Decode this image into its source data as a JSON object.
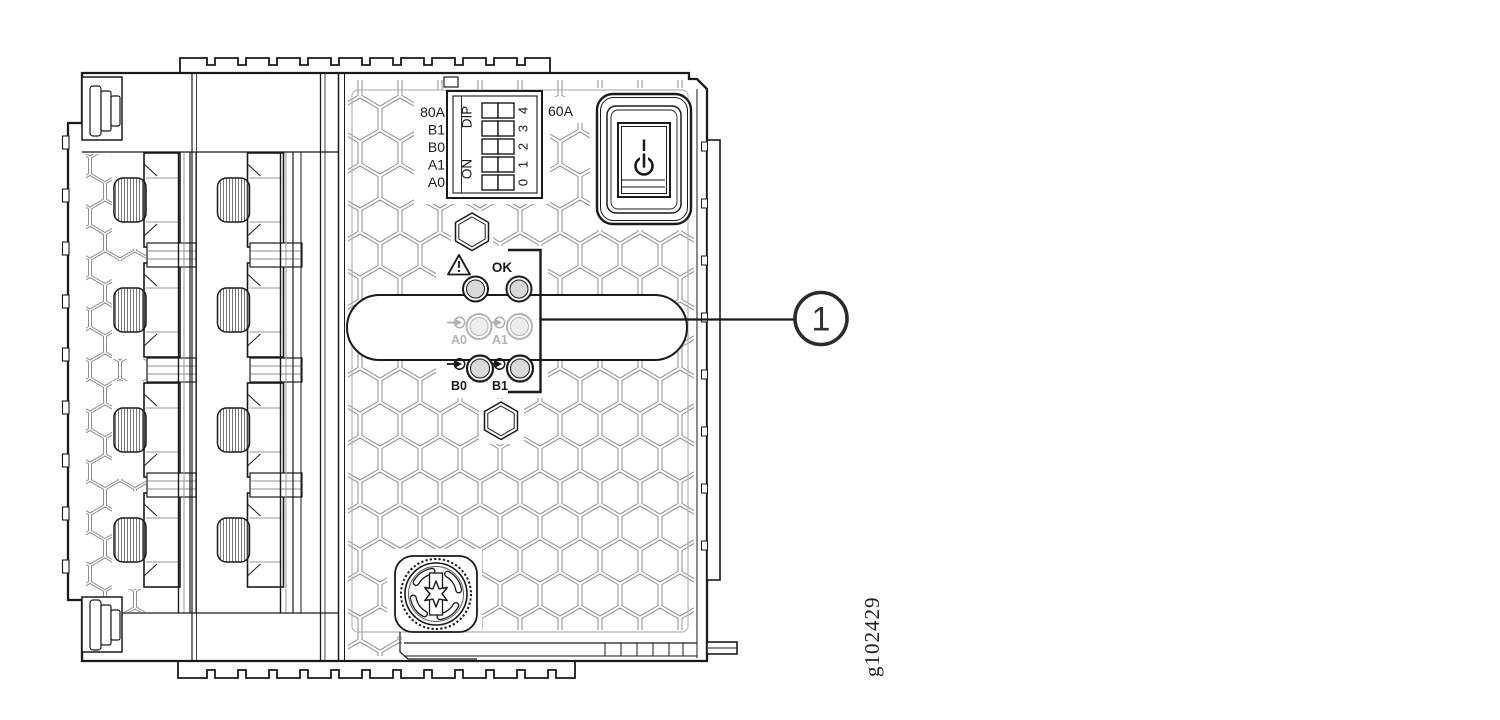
{
  "figure": {
    "id": "g102429"
  },
  "callout": {
    "number": "1",
    "target": "status-led-cluster"
  },
  "panel": {
    "dip_block": {
      "row_labels": [
        "80A",
        "B1",
        "B0",
        "A1",
        "A0"
      ],
      "dip_label": "DIP",
      "on_label": "ON",
      "position_labels": [
        "4",
        "3",
        "2",
        "1",
        "0"
      ],
      "rating_label": "60A"
    },
    "power_switch": {
      "on_label": "I",
      "symbol": "power-standby-icon"
    },
    "leds": {
      "alarm_icon": "warning-triangle-icon",
      "ok_label": "OK",
      "a0_label": "A0",
      "a1_label": "A1",
      "b0_label": "B0",
      "b1_label": "B1"
    }
  },
  "colors": {
    "line": "#1a1a1a",
    "hex_grid": "#8c8c8c",
    "muted": "#b3b3b3",
    "led_fill": "#d9d9d9",
    "muted_led_fill": "#ededed"
  }
}
